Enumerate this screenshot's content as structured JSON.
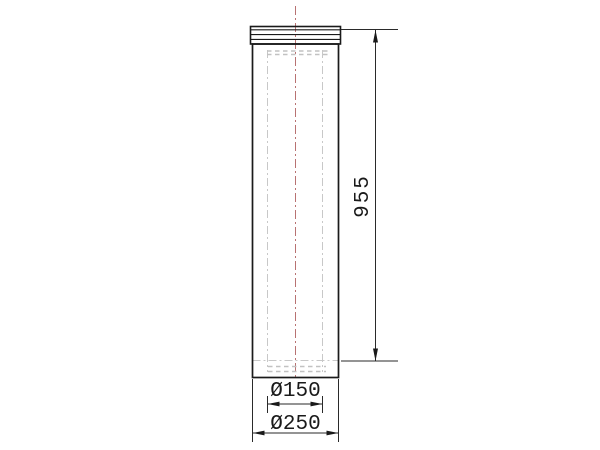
{
  "drawing": {
    "type": "technical-drawing-pipe-element",
    "dimensions": {
      "length": "955",
      "inner_diameter": "Ø150",
      "outer_diameter": "Ø250"
    },
    "colors": {
      "outline": "#1a1a1a",
      "dimension_line": "#2a2a2a",
      "hidden_line": "#c8c8c8",
      "centerline": "#b87272",
      "background": "#ffffff"
    }
  }
}
